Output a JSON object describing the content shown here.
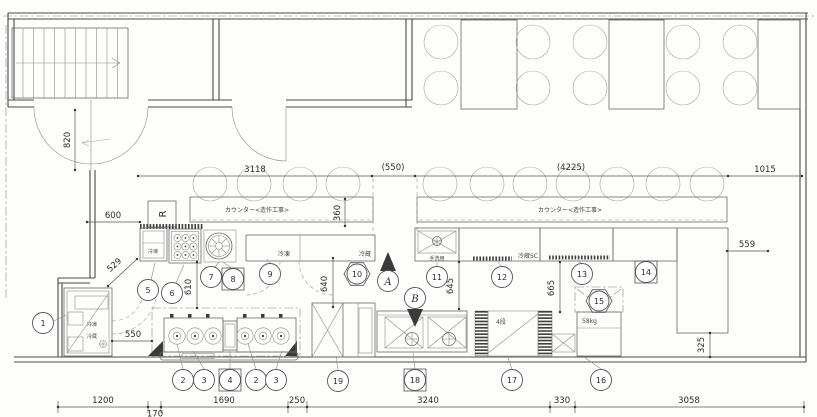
{
  "dims": {
    "door": "820",
    "entry_offset": "600",
    "diag": "529",
    "walkin_door": "550",
    "counter_left_len": "3118",
    "counter_gap": "(550)",
    "counter_right_len": "(4225)",
    "right_clear": "1015",
    "counter_depth": "360",
    "aisle_a": "610",
    "aisle_b": "640",
    "aisle_c": "645",
    "aisle_d": "665",
    "col_gap": "559",
    "col_offset": "325",
    "bottom": [
      "1200",
      "170",
      "1690",
      "250",
      "3240",
      "330",
      "3058"
    ]
  },
  "labels": {
    "counter_left": "カウンター<造作工事>",
    "counter_right": "カウンター<造作工事>",
    "walkin_freezer": "冷凍",
    "walkin_fridge": "冷蔵",
    "upright_freezer": "冷凍",
    "uc_freezer": "冷凍",
    "uc_fridge": "冷蔵",
    "hand_sink": "手洗用",
    "fridge_sc": "冷蔵SC",
    "shelf_tiers": "4段",
    "rice_weight": "58kg",
    "riser": "R"
  },
  "badges": {
    "b1": "1",
    "b2": "2",
    "b3": "3",
    "b4": "4",
    "b5": "5",
    "b6": "6",
    "b7": "7",
    "b8": "8",
    "b9": "9",
    "b10": "10",
    "b11": "11",
    "b12": "12",
    "b13": "13",
    "b14": "14",
    "b15": "15",
    "b16": "16",
    "b17": "17",
    "b18": "18",
    "b19": "19",
    "section_a": "A",
    "section_b": "B"
  }
}
